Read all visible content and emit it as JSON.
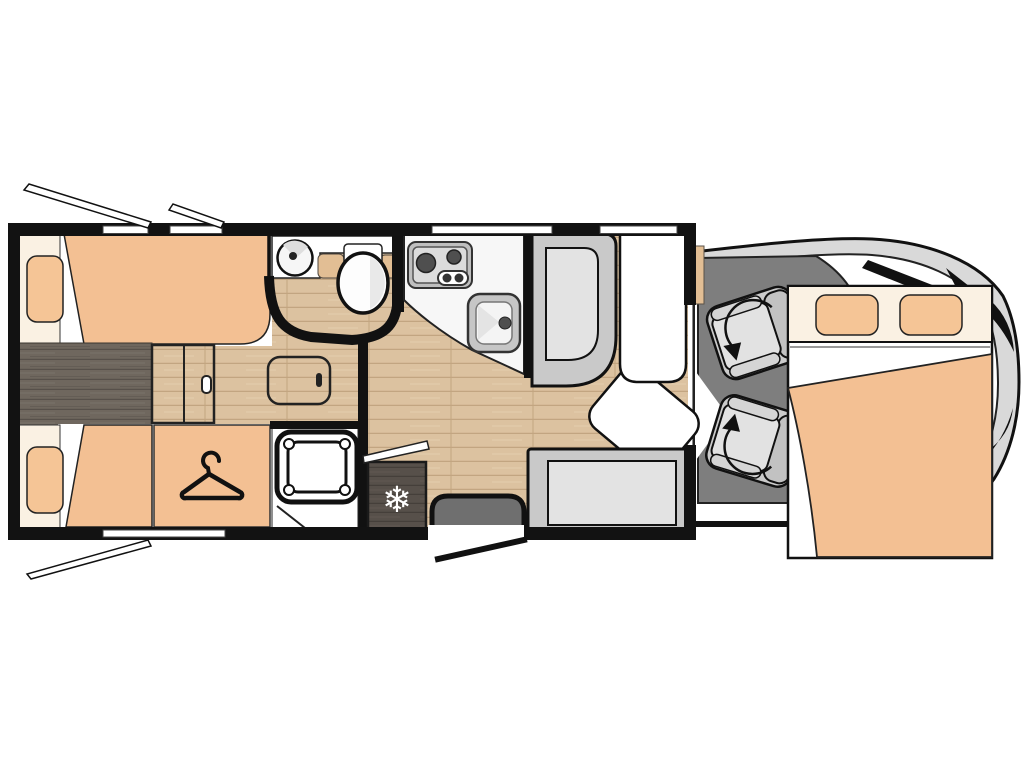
{
  "diagram": {
    "type": "motorhome-floorplan-top-view",
    "areas": {
      "rear_bedroom": [
        "single-bed-top",
        "single-bed-bottom",
        "pillow-top",
        "pillow-bottom",
        "center-walkway",
        "sliding-door",
        "wardrobe"
      ],
      "bathroom": [
        "round-washbasin",
        "toilet",
        "curved-wall",
        "door"
      ],
      "shower_room": [
        "shower-tray",
        "door"
      ],
      "kitchen": [
        "worktop",
        "hob-two-burners",
        "kitchen-sink",
        "fridge",
        "worktop-flap"
      ],
      "lounge": [
        "dinette-bench",
        "table",
        "table-extension",
        "side-bench",
        "floor-hatch",
        "entry-step",
        "entry-door"
      ],
      "cab": [
        "driver-swivel-seat",
        "passenger-swivel-seat",
        "drop-down-bed",
        "vehicle-front-outline",
        "windscreen"
      ]
    },
    "windows": [
      "rear-top-window-open",
      "rear-top-window-2-open",
      "rear-bottom-window-open",
      "kitchen-window",
      "lounge-window",
      "bottom-window"
    ]
  },
  "icons": {
    "snowflake_glyph": "❄",
    "hanger": "clothes-hanger-icon",
    "swivel": "rotation-arrow-icon"
  },
  "colors": {
    "background": "#FFFFFF",
    "wall": "#121212",
    "mattress": "#F3C093",
    "pillow": "#F5Cродит",
    "pillow_orange": "#F5C596",
    "headboard_cream": "#FAF1E3",
    "floor_light_wood": "#DCC2A0",
    "plank_line": "#C2A581",
    "walkway_dark_wood": "#6F675E",
    "fridge_wood": "#57504A",
    "cab_floor": "#7E7E7E",
    "vehicle_body": "#D9D9D9",
    "seat_outer": "#CBCBCB",
    "seat_cushion": "#E2E2E2",
    "seat_backrest": "#C2C2C2",
    "bench_outer": "#C9C9C9",
    "bench_inner": "#E3E3E3",
    "counter_white": "#F7F7F7",
    "appliance_gray": "#BFBFBF",
    "burner_dark": "#4F4F4F",
    "step_gray": "#6F6F6F",
    "cabinet_tan": "#E2BE94",
    "snowflake_white": "#FFFFFF"
  }
}
